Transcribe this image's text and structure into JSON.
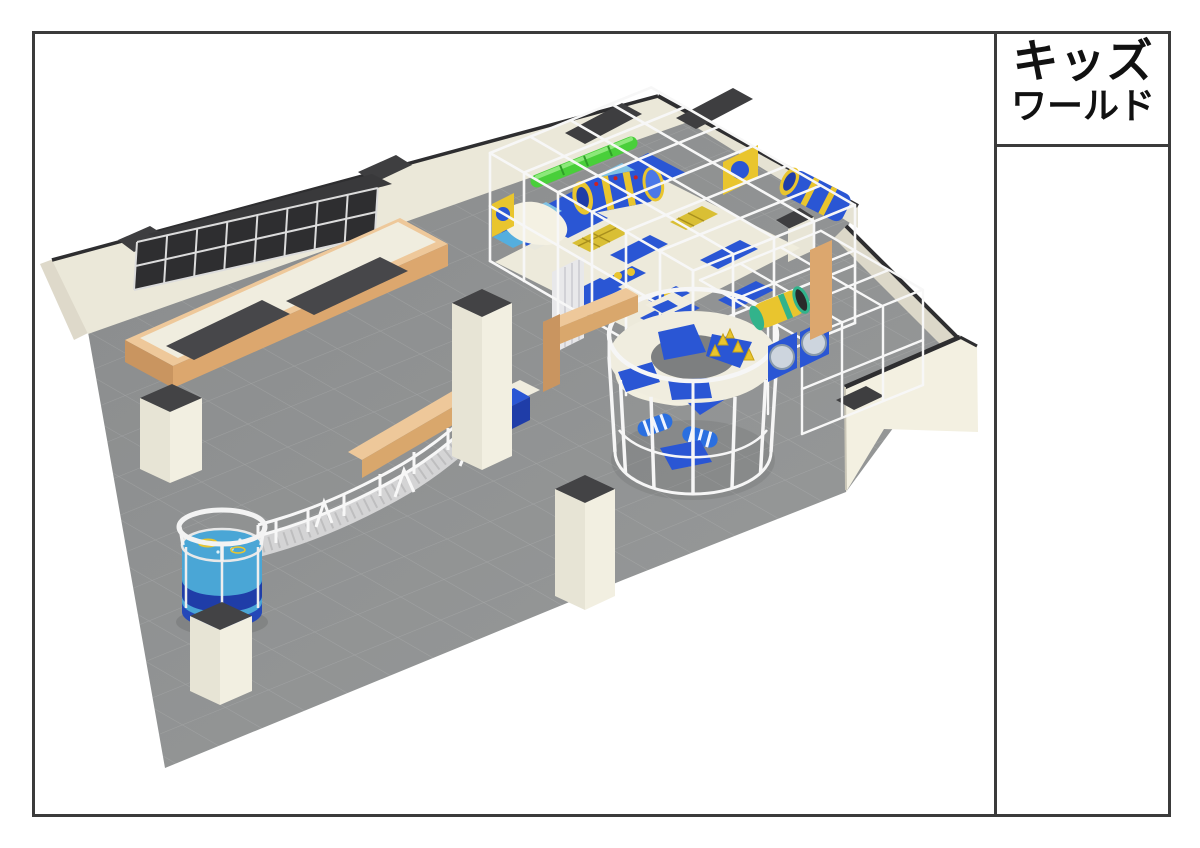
{
  "title_block": {
    "line1": "キッズ",
    "line2": "ワールド"
  },
  "scene": {
    "type": "3d-architectural-render",
    "subject": "indoor kids playground perspective view",
    "areas": [
      "wall-trampoline-panels",
      "floor-trampolines",
      "soft-play-frame-structure",
      "green-tube-slide",
      "crawl-tunnels",
      "circular-ring-tower",
      "porthole-panels",
      "elevated-snake-walkway",
      "ball-pit-cylinder",
      "wooden-partitions",
      "support-columns"
    ],
    "palette": {
      "floor": "#8f9192",
      "wall": "#ebe8d9",
      "wall_edge": "#2e2e30",
      "wood": "#eec89a",
      "wood_front": "#dca76e",
      "play_blue": "#2a56d4",
      "play_dark_blue": "#1f3da8",
      "play_yellow": "#e9c52e",
      "slide_green": "#49cf3a",
      "teal_ring": "#32b38b",
      "ball_blue": "#4aa6d6",
      "cyan_mat": "#7fc2e4",
      "frame_white": "#f7f7f7",
      "trampoline_bed": "#47474a",
      "column_top": "#434345",
      "deck_cream": "#f0eddf"
    }
  }
}
